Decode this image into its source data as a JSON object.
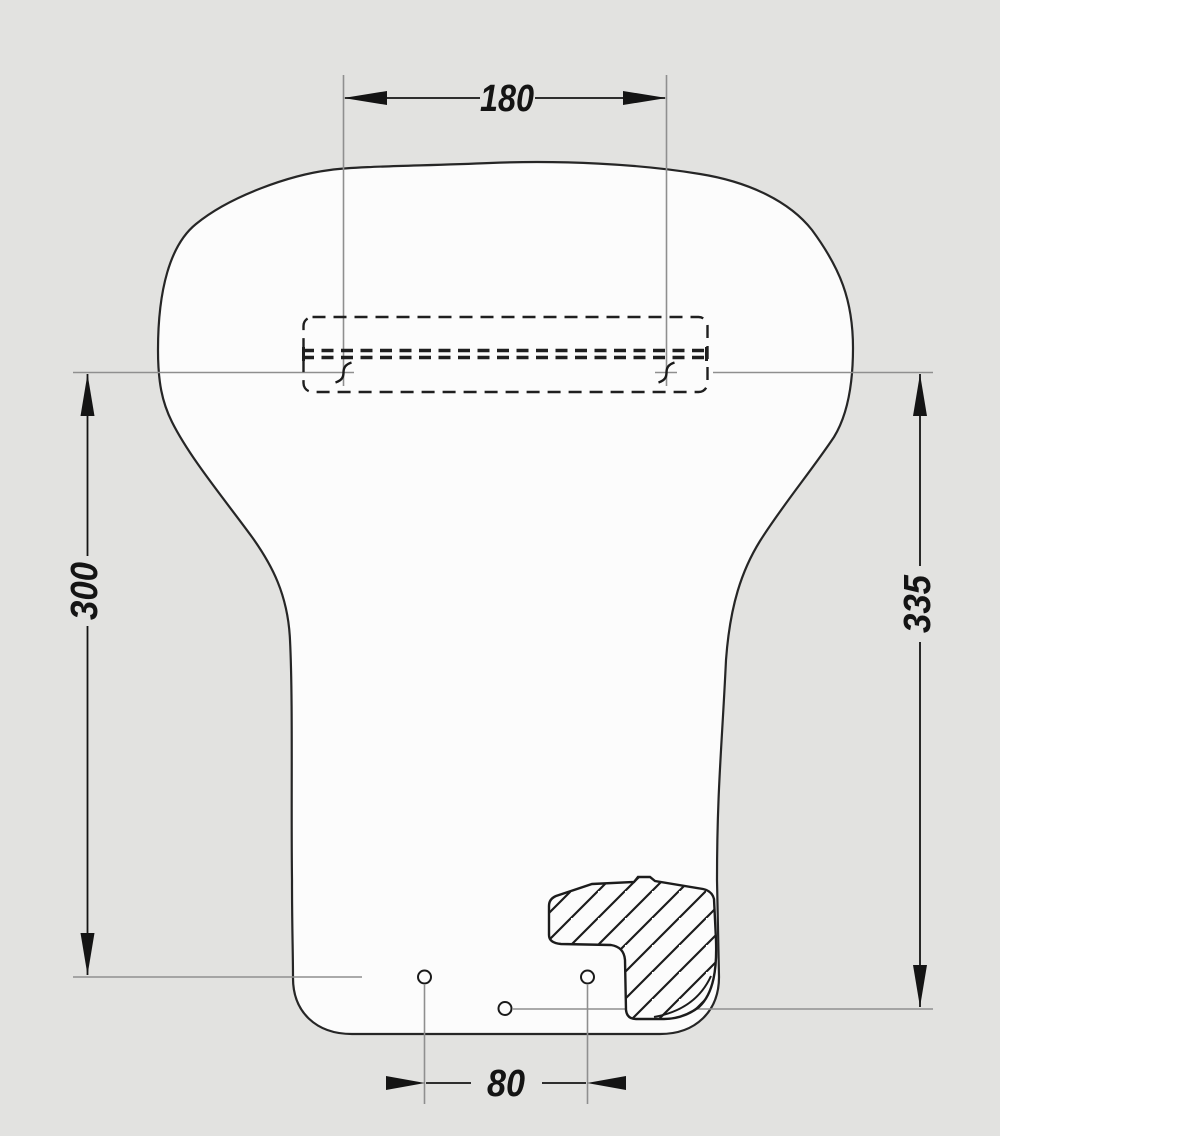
{
  "drawing": {
    "kind": "technical-dimension-drawing",
    "canvas_color": "#e2e2e0",
    "right_panel_color": "#ffffff",
    "part_fill_color": "#fcfcfc",
    "outline_color": "#262626",
    "extension_line_color": "#8f8f8f",
    "dimension_color": "#141414",
    "dimensions": {
      "top_width": {
        "value": "180"
      },
      "left_height": {
        "value": "300"
      },
      "right_height": {
        "value": "335"
      },
      "bottom_hole_spacing": {
        "value": "80"
      }
    }
  }
}
